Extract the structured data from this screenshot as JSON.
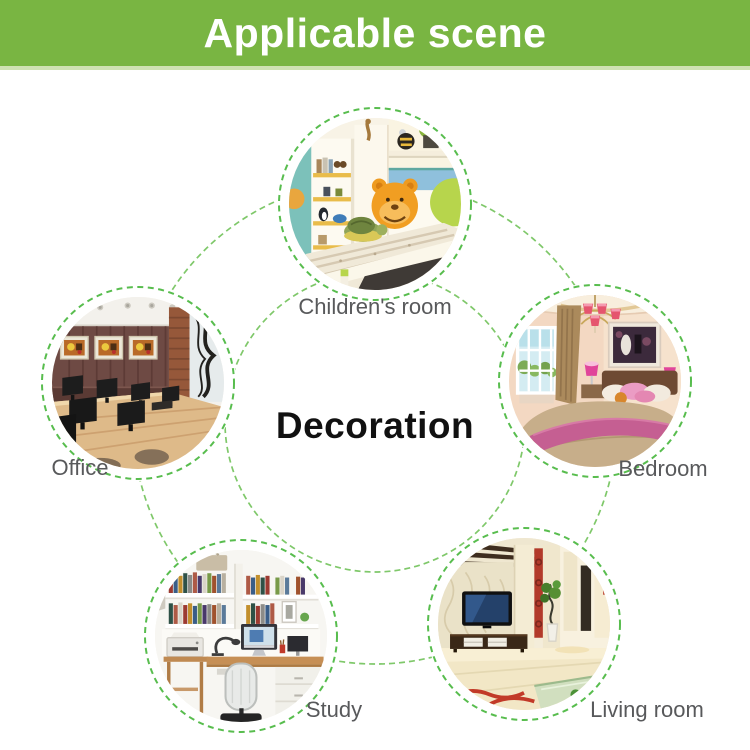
{
  "banner": {
    "title": "Applicable scene",
    "bg_color": "#79b542",
    "text_color": "#ffffff"
  },
  "diagram": {
    "center_label": "Decoration",
    "connector_color": "#7fc86a",
    "scene_ring_color": "#58bd4e",
    "label_color": "#58595b",
    "scenes": [
      {
        "id": "children-room",
        "label": "Children's room",
        "photo": "children-room-photo"
      },
      {
        "id": "office",
        "label": "Office",
        "photo": "office-photo"
      },
      {
        "id": "bedroom",
        "label": "Bedroom",
        "photo": "bedroom-photo"
      },
      {
        "id": "study",
        "label": "Study",
        "photo": "study-photo"
      },
      {
        "id": "living-room",
        "label": "Living room",
        "photo": "living-room-photo"
      }
    ]
  }
}
